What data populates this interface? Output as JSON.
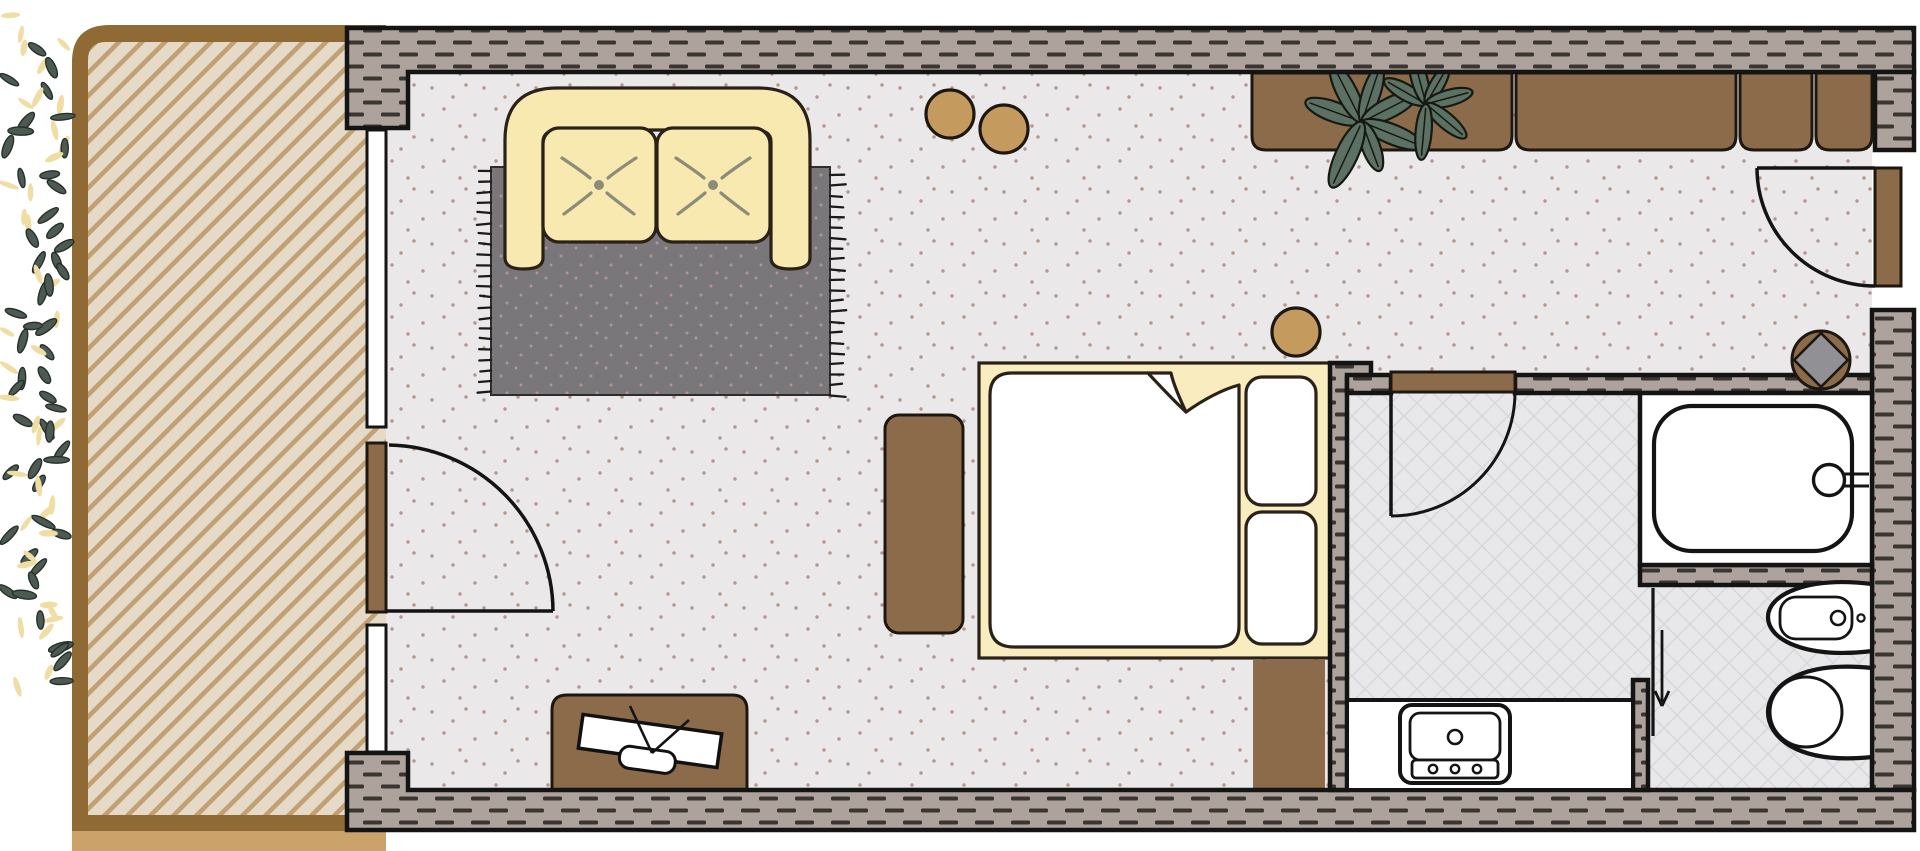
{
  "page": {
    "title": "Studio hotel room floor plan",
    "background": "#ffffff"
  },
  "plan": {
    "rooms": [
      {
        "label": "Living and sleeping room",
        "floor_texture": "speckled"
      },
      {
        "label": "Bathroom",
        "floor_texture": "diamond tile"
      },
      {
        "label": "Balcony terrace",
        "floor_texture": "diagonal wood deck"
      }
    ],
    "furniture": [
      {
        "label": "Two-seat sofa with tufted cushions"
      },
      {
        "label": "Area rug with fringe"
      },
      {
        "label": "Round pouf stool"
      },
      {
        "label": "Round pouf stool"
      },
      {
        "label": "Round bedside stool"
      },
      {
        "label": "Wardrobe closet unit with four sections"
      },
      {
        "label": "Potted plant on wardrobe"
      },
      {
        "label": "Double bed with duvet and two pillows"
      },
      {
        "label": "Bench beside bed"
      },
      {
        "label": "Bedside cabinet"
      },
      {
        "label": "Desk cabinet"
      },
      {
        "label": "Television on desk"
      }
    ],
    "fixtures": [
      {
        "label": "Bathtub with faucet"
      },
      {
        "label": "Washbasin vanity"
      },
      {
        "label": "Bidet"
      },
      {
        "label": "Toilet"
      },
      {
        "label": "Shower partition with entry arrow"
      },
      {
        "label": "Decorative diamond wall element"
      }
    ],
    "doors": [
      {
        "label": "Balcony door with swing arc"
      },
      {
        "label": "Entrance door with swing arc"
      },
      {
        "label": "Bathroom door with swing arc"
      }
    ],
    "windows": [
      {
        "label": "Window to balcony"
      },
      {
        "label": "Window to balcony"
      }
    ],
    "colors": {
      "wall_fill": "#ada39c",
      "wall_dash": "#3a3531",
      "outline": "#141414",
      "room_floor": "#eae8e9",
      "floor_dot": "#b5968b",
      "tile_floor": "#e8e8ea",
      "tile_line": "#d7d7db",
      "balcony_deck": "#e5dac8",
      "balcony_stripe": "#c1a074",
      "balcony_border": "#8f6a35",
      "ground": "#cba269",
      "furniture_brown": "#8c6b4b",
      "stool_tan": "#c59a5e",
      "sofa_cream": "#f8e9b0",
      "bed_yellow": "#f9ecbe",
      "rug_gray": "#7a777a",
      "rug_dot": "#b09697",
      "tuft": "#8d8c79",
      "plant_green": "#5d7064",
      "leaf_dark": "#4d5a52",
      "leaf_yellow": "#f0dda4",
      "white": "#ffffff"
    }
  }
}
